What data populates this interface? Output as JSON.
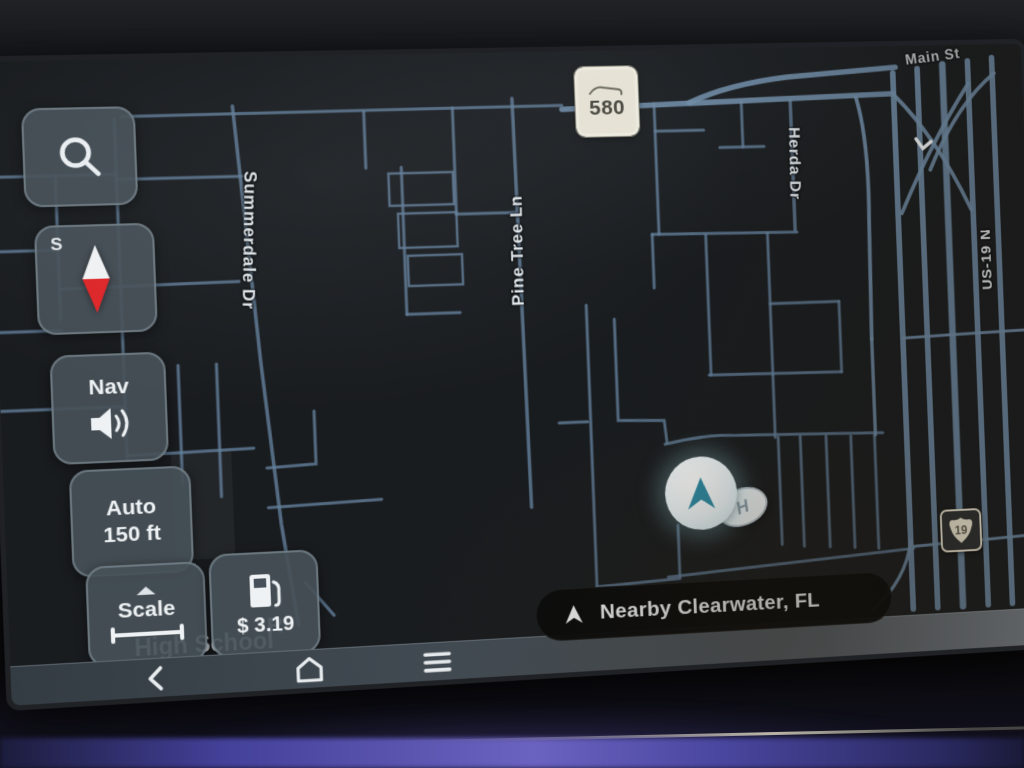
{
  "map": {
    "road_labels": {
      "summerdale": "Summerdale Dr",
      "pine_tree": "Pine Tree Ln",
      "herda": "Herda Dr",
      "us19": "US-19 N",
      "main_st": "Main St"
    },
    "poi": {
      "fragment": "R",
      "name": "High School"
    },
    "shields": {
      "fl_580": "580",
      "us_19": "19"
    },
    "vehicle": {
      "badge_letter": "H"
    }
  },
  "controls": {
    "search": {
      "icon": "magnifier"
    },
    "compass": {
      "cardinal": "S",
      "icon": "compass-needle"
    },
    "nav_audio": {
      "label": "Nav",
      "icon": "speaker"
    },
    "zoom": {
      "mode": "Auto",
      "range": "150 ft"
    },
    "scale": {
      "label": "Scale",
      "icon": "scale-ruler",
      "expand_icon": "triangle-up"
    },
    "fuel": {
      "price": "$ 3.19",
      "icon": "gas-pump"
    }
  },
  "status_pill": {
    "label": "Nearby Clearwater, FL",
    "icon": "navigation-arrow"
  },
  "system_bar": {
    "back_icon": "chevron-left",
    "home_icon": "house",
    "menu_icon": "hamburger"
  },
  "colors": {
    "compass_red": "#e02528",
    "vehicle_teal": "#2e8ca6",
    "road_blue": "#63809b",
    "shield_cream": "#efeadb",
    "button_bg": "#46505a",
    "ambient_purple": "#5b55b0"
  }
}
